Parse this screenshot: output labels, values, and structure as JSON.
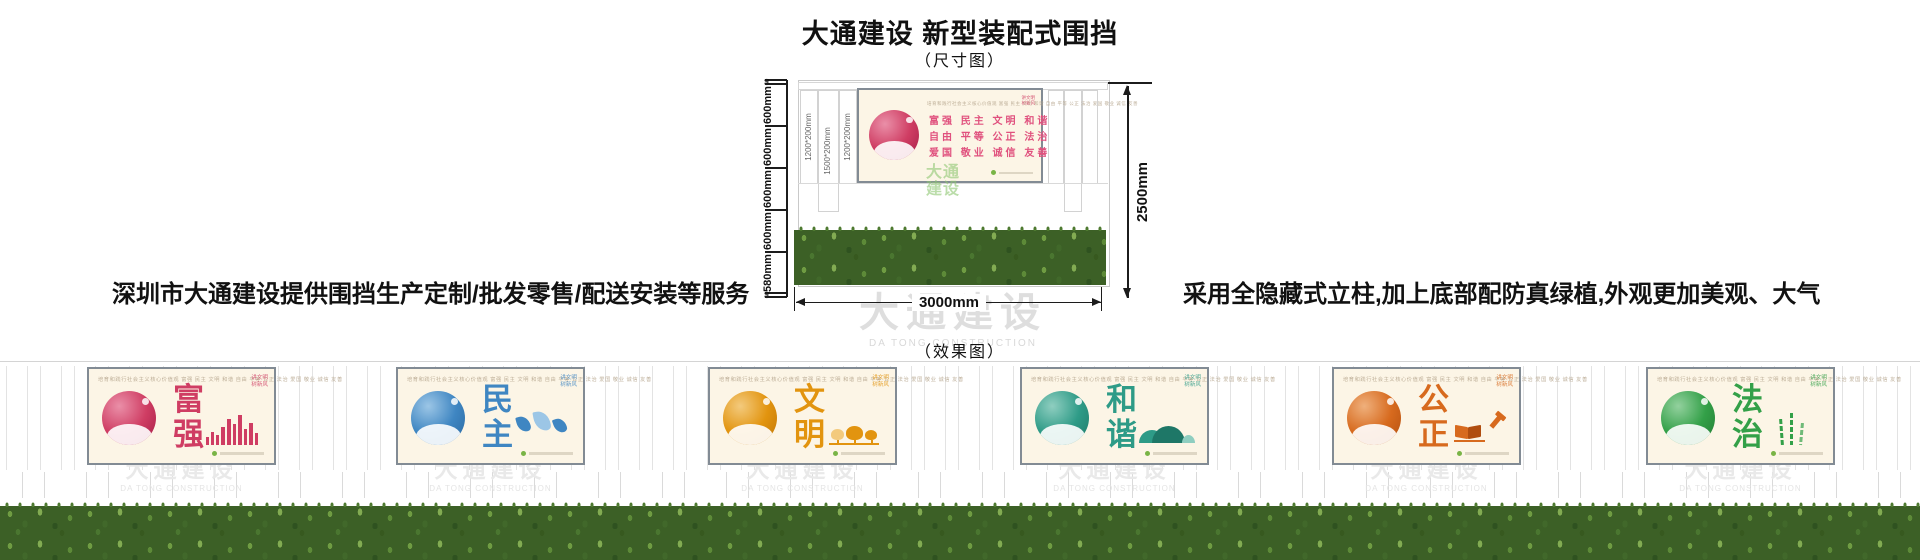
{
  "title": "大通建设 新型装配式围挡",
  "dim_caption": "（尺寸图）",
  "effect_caption": "（效果图）",
  "left_note": "深圳市大通建设提供围挡生产定制/批发零售/配送安装等服务",
  "right_note": "采用全隐藏式立柱,加上底部配防真绿植,外观更加美观、大气",
  "colors": {
    "accent_orange": "#fb7c00",
    "values_pink": "#e0517e",
    "watermark_gray": "#dedede",
    "grass_green": "#3c6026",
    "cert_green": "#79b446"
  },
  "watermark": {
    "cn": "大通建设",
    "en": "DA TONG CONSTRUCTION"
  },
  "shared": {
    "header": "培育和践行社会主义核心价值观  富强 民主 文明 和谐 自由 平等 公正 法治 爱国 敬业 诚信 友善",
    "corner": [
      "讲文明",
      "树新风"
    ]
  },
  "diagram": {
    "ruler": [
      "60",
      "600mm",
      "600mm",
      "600mm",
      "600mm",
      "580mm",
      "60"
    ],
    "board_labels": [
      "1200*200mm",
      "1500*200mm",
      "1200*200mm"
    ],
    "width_label": "3000mm",
    "height_label": "2500mm",
    "green_watermark": "大通建设",
    "banner_rows": [
      "富强  民主  文明  和谐",
      "自由  平等  公正  法治",
      "爱国  敬业  诚信  友善"
    ]
  },
  "panels": [
    {
      "word": "富强",
      "color": "#cf3d63",
      "dark": "#a31c46",
      "light": "#ea8fa8",
      "motif": "skyline"
    },
    {
      "word": "民主",
      "color": "#3f86c2",
      "dark": "#29679f",
      "light": "#9cc6e6",
      "motif": "doves"
    },
    {
      "word": "文明",
      "color": "#e2940f",
      "dark": "#bd7407",
      "light": "#f3ca7d",
      "motif": "trees"
    },
    {
      "word": "和谐",
      "color": "#2e9b87",
      "dark": "#1e7767",
      "light": "#8fcec0",
      "motif": "mountains"
    },
    {
      "word": "公正",
      "color": "#d76a1e",
      "dark": "#b04d0f",
      "light": "#efb07c",
      "motif": "lawbook"
    },
    {
      "word": "法治",
      "color": "#33a048",
      "dark": "#227a33",
      "light": "#93d19e",
      "motif": "bamboo"
    }
  ]
}
